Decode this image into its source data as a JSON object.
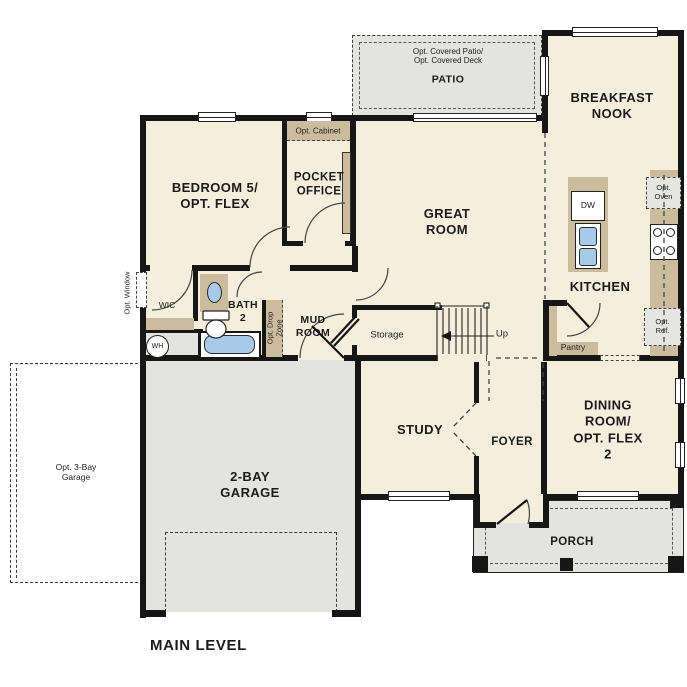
{
  "plan_title": "MAIN LEVEL",
  "labels": {
    "patio_opt": "Opt. Covered Patio/\nOpt. Covered Deck",
    "patio": "PATIO",
    "breakfast_nook": "BREAKFAST\nNOOK",
    "bedroom5": "BEDROOM 5/\nOPT. FLEX",
    "pocket_office": "POCKET\nOFFICE",
    "opt_cabinet": "Opt. Cabinet",
    "great_room": "GREAT\nROOM",
    "kitchen": "KITCHEN",
    "dw": "DW",
    "opt_oven": "Opt.\nOven",
    "opt_ref": "Opt.\nRef.",
    "pantry": "Pantry",
    "wic": "WIC",
    "bath2": "BATH\n2",
    "mud_room": "MUD\nROOM",
    "opt_drop_zone": "Opt. Drop\nZone",
    "opt_window": "Opt. Window",
    "wh": "WH",
    "storage": "Storage",
    "up": "Up",
    "study": "STUDY",
    "foyer": "FOYER",
    "dining": "DINING ROOM/\nOPT. FLEX 2",
    "porch": "PORCH",
    "garage": "2-BAY\nGARAGE",
    "opt_garage": "Opt. 3-Bay\nGarage"
  },
  "colors": {
    "floor": "#f5eedd",
    "hard_surface": "#e3e3df",
    "counter": "#cbbc9d",
    "fixture": "#a9c9e8",
    "wall": "#161616"
  }
}
